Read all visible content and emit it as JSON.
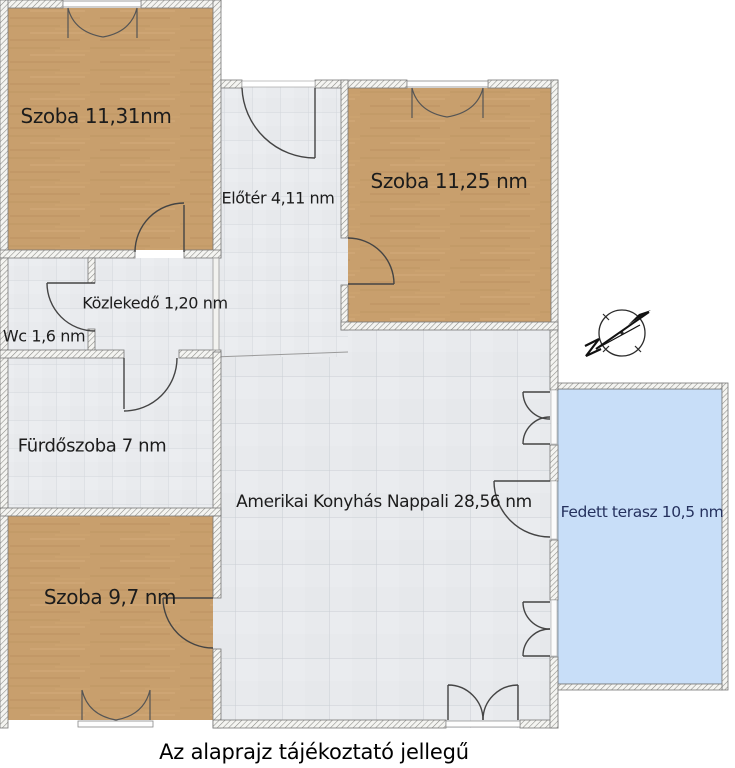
{
  "caption": "Az alaprajz tájékoztató jellegű",
  "rooms": {
    "szoba_felso_bal": {
      "label": "Szoba 11,31nm"
    },
    "eloter": {
      "label": "Előtér 4,11 nm"
    },
    "szoba_felso_jobb": {
      "label": "Szoba 11,25 nm"
    },
    "wc": {
      "label": "Wc 1,6 nm"
    },
    "kozlekedo": {
      "label": "Közlekedő 1,20 nm"
    },
    "furdoszoba": {
      "label": "Fürdőszoba 7 nm"
    },
    "nappali": {
      "label": "Amerikai Konyhás Nappali 28,56 nm"
    },
    "szoba_also": {
      "label": "Szoba 9,7 nm"
    },
    "fedett_terasz": {
      "label": "Fedett terasz 10,5 nm"
    }
  },
  "icons": {
    "compass": "north-arrow-compass-icon"
  },
  "colors": {
    "wood_floor": "#c89f6d",
    "tile_floor": "#e9ebee",
    "terrace_fill": "#c8def8",
    "terrace_text": "#25315e",
    "wall_hatch_line": "#8a8a86",
    "door_stroke": "#444444",
    "label_text": "#1c1c1c",
    "caption_text": "#000000"
  }
}
